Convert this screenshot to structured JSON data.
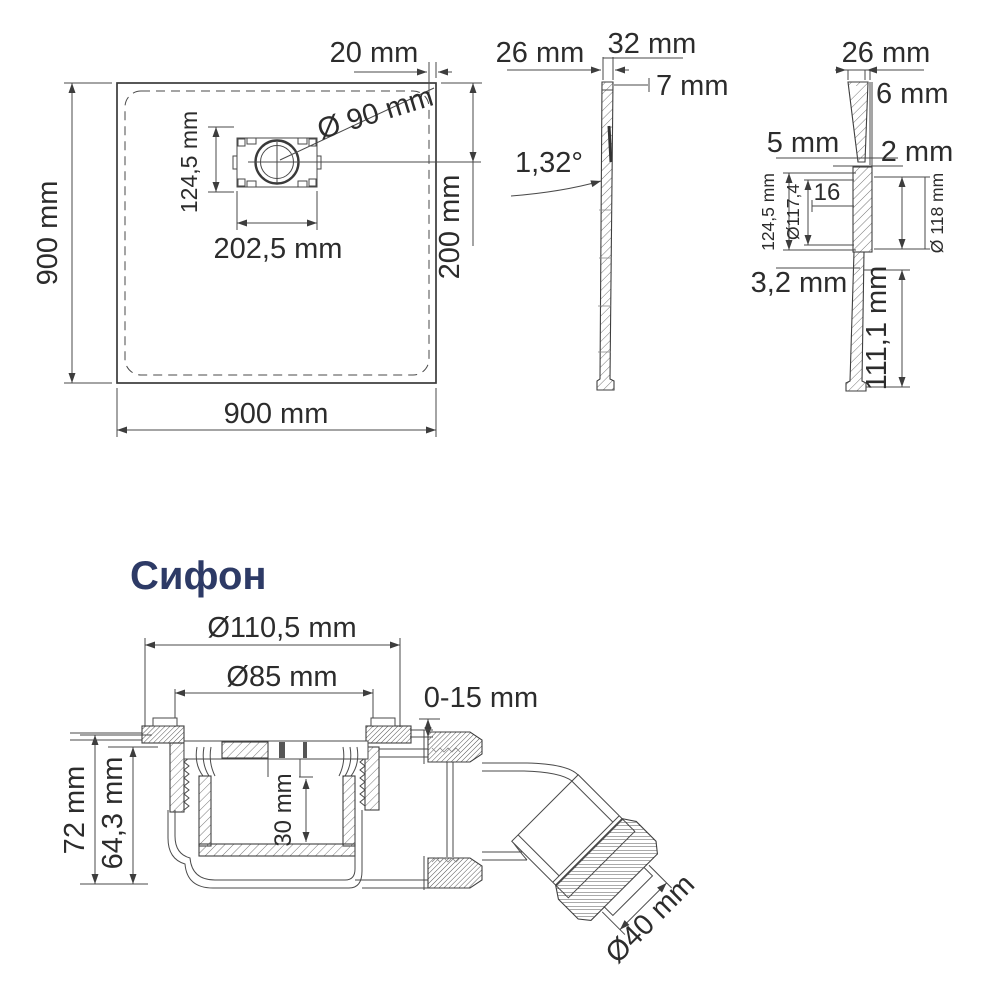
{
  "page": {
    "background_color": "#ffffff",
    "line_color": "#3a3a3a",
    "accent_color": "#2d3a66"
  },
  "tray_plan": {
    "width": "900 mm",
    "height": "900 mm",
    "edge_offset": "20 mm",
    "drain_diameter": "Ø 90 mm",
    "drain_cutout_height": "124,5 mm",
    "drain_cutout_width": "202,5 mm",
    "drain_center_offset": "200 mm"
  },
  "tray_profile": {
    "edge_thickness": "26 mm",
    "top_thickness": "32 mm",
    "lip_height": "7 mm",
    "slope_angle": "1,32°"
  },
  "drain_section": {
    "edge_thickness": "26 mm",
    "lip_height": "6 mm",
    "wall_left": "5 mm",
    "wall_right": "2 mm",
    "inset": "16",
    "cutout_height": "124,5 mm",
    "inner_diameter": "Ø117,4",
    "outer_diameter": "Ø 118 mm",
    "sheet_thickness": "3,2 mm",
    "drain_depth": "111,1 mm"
  },
  "siphon": {
    "title": "Сифон",
    "flange_diameter": "Ø110,5 mm",
    "grate_diameter": "Ø85 mm",
    "height_adjustment": "0-15 mm",
    "total_height": "72 mm",
    "body_height": "64,3 mm",
    "water_seal": "30 mm",
    "outlet_diameter": "Ø40 mm"
  }
}
